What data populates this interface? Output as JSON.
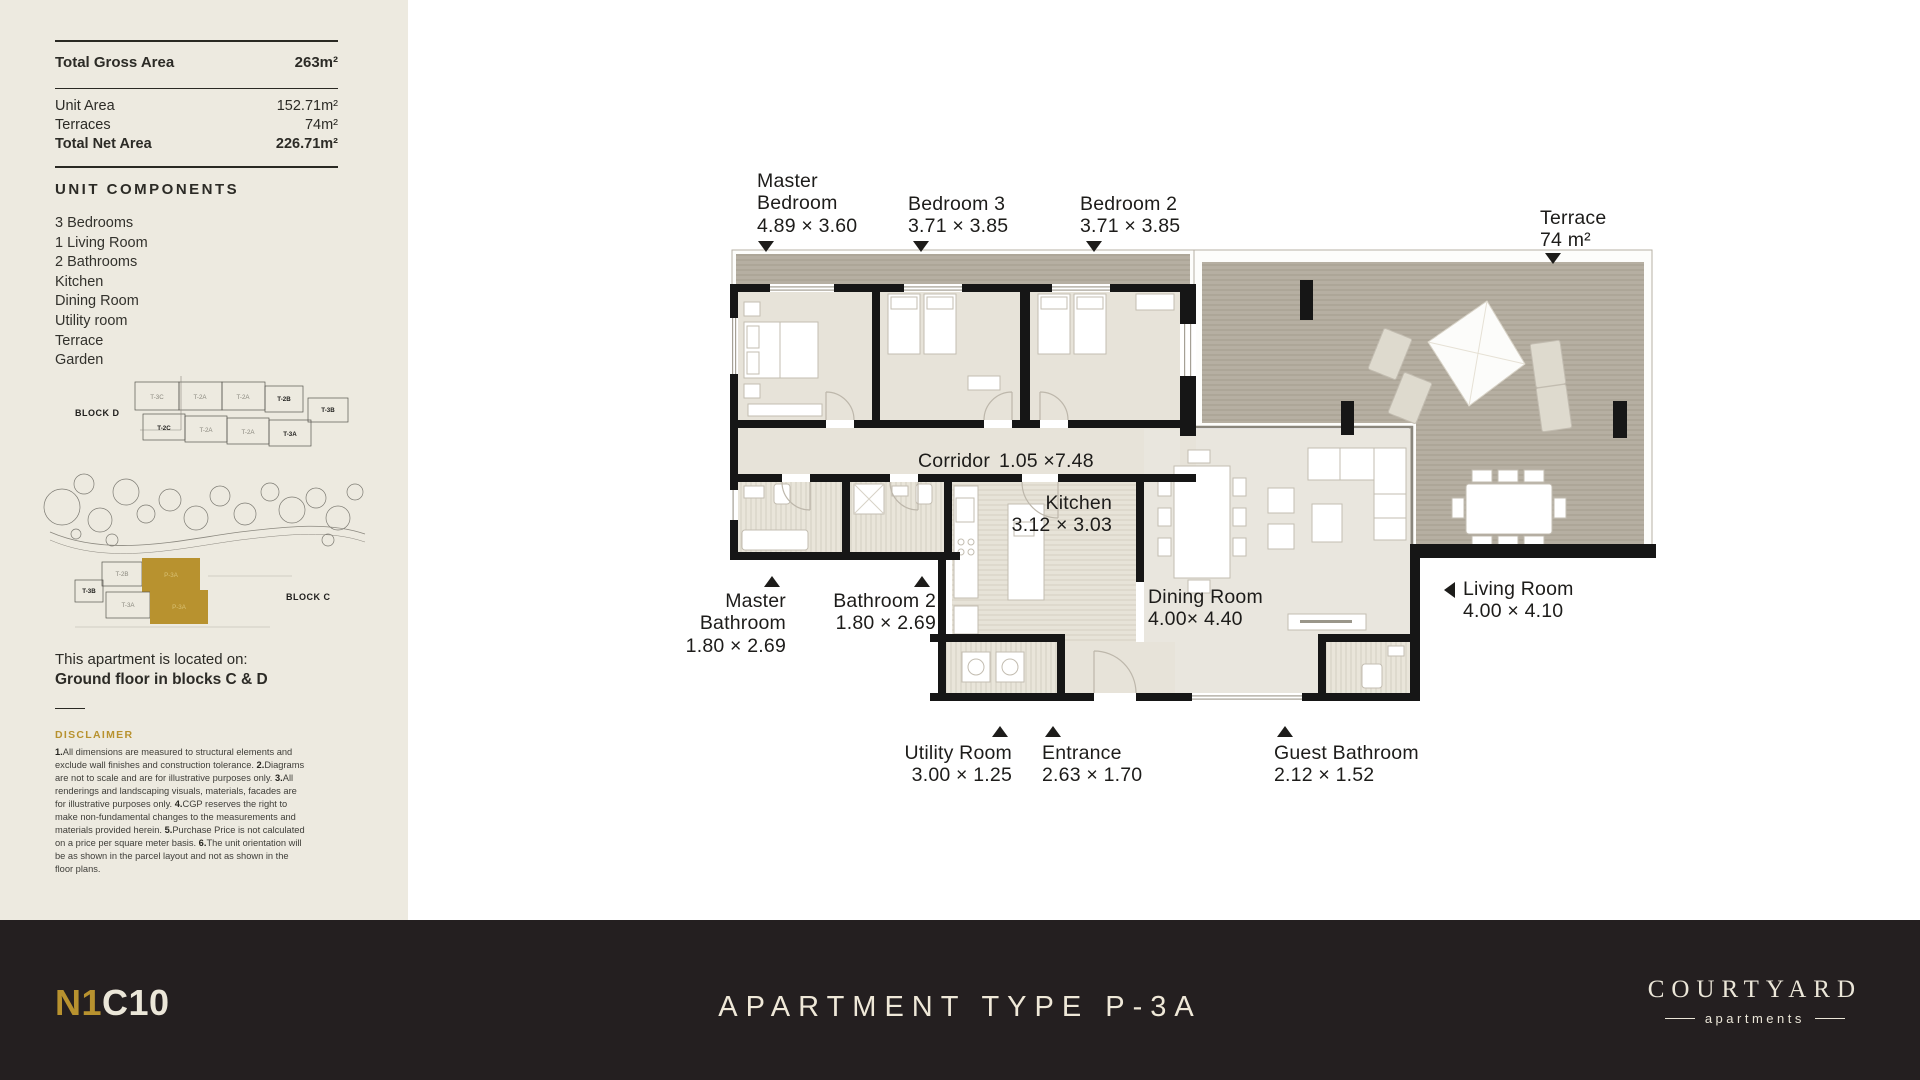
{
  "sidebar": {
    "stats": {
      "gross_label": "Total Gross Area",
      "gross_value": "263m²",
      "rows": [
        {
          "label": "Unit Area",
          "value": "152.71m²"
        },
        {
          "label": "Terraces",
          "value": "74m²"
        },
        {
          "label": "Total Net Area",
          "value": "226.71m²"
        }
      ]
    },
    "components": {
      "title": "UNIT COMPONENTS",
      "items": [
        "3 Bedrooms",
        "1 Living Room",
        "2 Bathrooms",
        "Kitchen",
        "Dining Room",
        "Utility room",
        "Terrace",
        "Garden"
      ]
    },
    "siteplan": {
      "block_d_label": "BLOCK D",
      "block_c_label": "BLOCK C",
      "block_d_row1": [
        "T-3C",
        "T-2A",
        "T-2A",
        "T-2B"
      ],
      "block_d_row2": [
        "T-2C",
        "T-2A",
        "T-2A",
        "T-3A"
      ],
      "block_d_right": "T-3B",
      "block_c_units": [
        "T-2B",
        "P-3A",
        "T-3B",
        "T-3A",
        "P-3A"
      ]
    },
    "location": {
      "line1": "This apartment is located on:",
      "line2": "Ground floor in blocks C & D"
    },
    "disclaimer": {
      "title": "DISCLAIMER",
      "segments": [
        {
          "n": "1.",
          "t": "All dimensions are measured to structural elements and exclude wall finishes and construction tolerance. "
        },
        {
          "n": "2.",
          "t": "Diagrams are not to scale and are for illustrative purposes only. "
        },
        {
          "n": "3.",
          "t": "All renderings and landscaping visuals, materials, facades are for illustrative purposes only. "
        },
        {
          "n": "4.",
          "t": "CGP reserves the right to make non-fundamental changes to the measurements and materials provided herein. "
        },
        {
          "n": "5.",
          "t": "Purchase Price is not calculated on a price per square meter basis. "
        },
        {
          "n": "6.",
          "t": "The unit orientation will be as shown in the parcel layout and not as shown in the floor plans."
        }
      ]
    }
  },
  "plan": {
    "labels": {
      "master_bedroom": {
        "name": "Master Bedroom",
        "dims": "4.89 × 3.60"
      },
      "bedroom_3": {
        "name": "Bedroom 3",
        "dims": "3.71 × 3.85"
      },
      "bedroom_2": {
        "name": "Bedroom 2",
        "dims": "3.71 × 3.85"
      },
      "terrace": {
        "name": "Terrace",
        "dims": "74 m²"
      },
      "corridor": {
        "name": "Corridor",
        "dims": "1.05 ×7.48"
      },
      "kitchen": {
        "name": "Kitchen",
        "dims": "3.12 × 3.03"
      },
      "master_bathroom": {
        "name": "Master Bathroom",
        "dims": "1.80 × 2.69"
      },
      "bathroom_2": {
        "name": "Bathroom 2",
        "dims": "1.80 × 2.69"
      },
      "dining_room": {
        "name": "Dining Room",
        "dims": "4.00× 4.40"
      },
      "living_room": {
        "name": "Living Room",
        "dims": "4.00 × 4.10"
      },
      "utility_room": {
        "name": "Utility Room",
        "dims": "3.00 × 1.25"
      },
      "entrance": {
        "name": "Entrance",
        "dims": "2.63 × 1.70"
      },
      "guest_bathroom": {
        "name": "Guest Bathroom",
        "dims": "2.12 × 1.52"
      }
    }
  },
  "footer": {
    "code_gold": "N1",
    "code_rest": "C10",
    "title": "APARTMENT TYPE P-3A",
    "brand": "COURTYARD",
    "brand_sub": "apartments"
  },
  "colors": {
    "gold": "#b8922f",
    "sidebar_bg": "#edeae0",
    "footer_bg": "#241f20",
    "cream": "#ebe6d8",
    "wall": "#161616",
    "terrace_fill": "#b6afa2"
  }
}
